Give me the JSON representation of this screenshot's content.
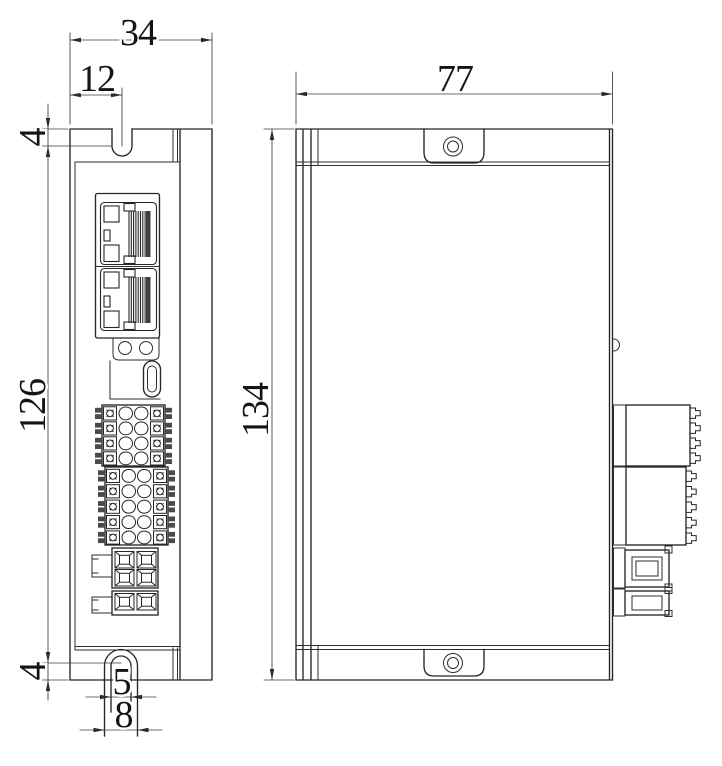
{
  "drawing": {
    "type": "mechanical-dimension-drawing",
    "views": {
      "front": "front-view",
      "side": "side-view"
    },
    "colors": {
      "line": "#262626",
      "background": "#ffffff"
    },
    "dimensions": {
      "front_width": "34",
      "slot_offset": "12",
      "top_slot_depth": "4",
      "mounting_pitch": "126",
      "bottom_slot_depth": "4",
      "slot_width": "5",
      "tab_width": "8",
      "body_depth": "77",
      "overall_height": "134"
    }
  }
}
